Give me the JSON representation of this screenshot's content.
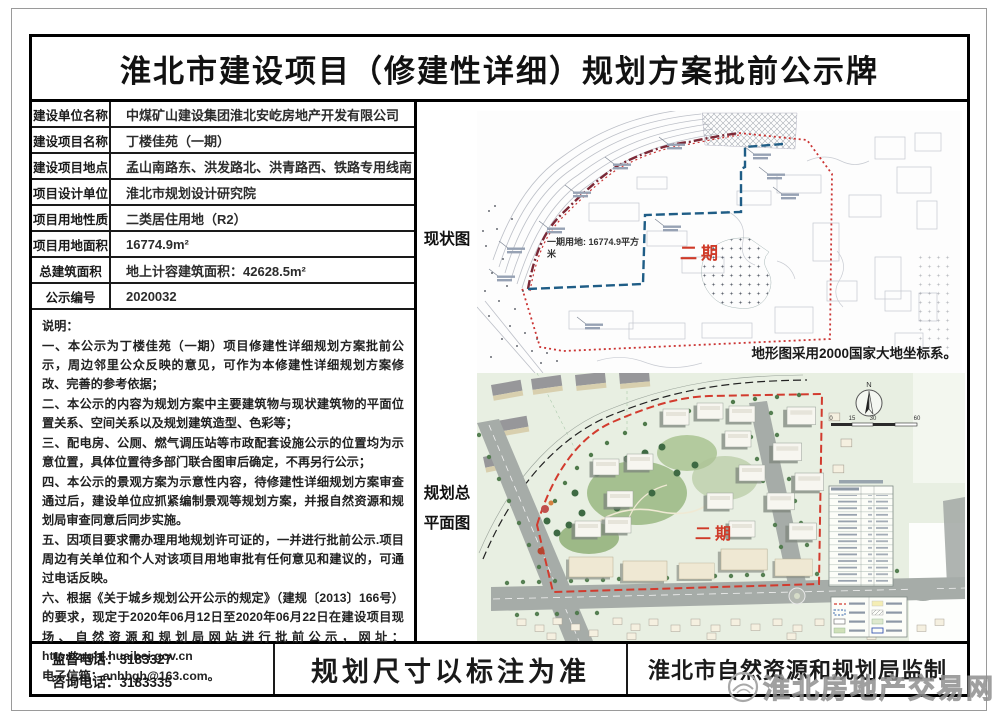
{
  "title": "淮北市建设项目（修建性详细）规划方案批前公示牌",
  "info_table": {
    "rows": [
      {
        "label": "建设单位名称",
        "value": "中煤矿山建设集团淮北安屹房地产开发有限公司"
      },
      {
        "label": "建设项目名称",
        "value": "丁楼佳苑（一期）"
      },
      {
        "label": "建设项目地点",
        "value": "孟山南路东、洪发路北、洪青路西、铁路专用线南"
      },
      {
        "label": "项目设计单位",
        "value": "淮北市规划设计研究院"
      },
      {
        "label": "项目用地性质",
        "value": "二类居住用地（R2）"
      },
      {
        "label": "项目用地面积",
        "value": "16774.9m²"
      },
      {
        "label": "总建筑面积",
        "value": "地上计容建筑面积：42628.5m²"
      },
      {
        "label": "公示编号",
        "value": "2020032"
      }
    ]
  },
  "notes": {
    "heading": "说明：",
    "items": [
      "一、本公示为丁楼佳苑（一期）项目修建性详细规划方案批前公示，周边邻里公众反映的意见，可作为本修建性详细规划方案修改、完善的参考依据；",
      "二、本公示的内容为规划方案中主要建筑物与现状建筑物的平面位置关系、空间关系以及规划建筑造型、色彩等；",
      "三、配电房、公厕、燃气调压站等市政配套设施公示的位置均为示意位置，具体位置待多部门联合图审后确定，不再另行公示；",
      "四、本公示的景观方案为示意性内容，待修建性详细规划方案审查通过后，建设单位应抓紧编制景观等规划方案，并报自然资源和规划局审查同意后同步实施。",
      "五、因项目要求需办理用地规划许可证的，一并进行批前公示.项目周边有关单位和个人对该项目用地审批有任何意见和建议的，可通过电话反映。",
      "六、根据《关于城乡规划公开公示的规定》（建规〔2013〕166号）的要求，现定于2020年06月12日至2020年06月22日在建设项目现场、自然资源和规划局网站进行批前公示，网址：http://zrghj.huaibei.gov.cn"
    ],
    "email_line": "电子信箱：anhbgh@163.com。"
  },
  "maps": {
    "site_map": {
      "side_label": "现状图",
      "phase1_area_text": "一期用地: 16774.9平方米",
      "phase2_label": "二期",
      "datum_note": "地形图采用2000国家大地坐标系。"
    },
    "plan_map": {
      "side_label_line1": "规划总",
      "side_label_line2": "平面图",
      "phase2_label": "二期",
      "compass_label": "N",
      "scale_ticks": [
        "0",
        "15",
        "30",
        "60"
      ]
    }
  },
  "footer": {
    "supervision_phone": "监督电话：3183327",
    "consult_phone": "咨询电话：3183335",
    "dimension_note": "规划尺寸以标注为准",
    "issuer": "淮北市自然资源和规划局监制"
  },
  "watermark": {
    "text": "淮北房地产交易网"
  },
  "colors": {
    "phase1_boundary": "#1f5d86",
    "phase1_arc": "#7b2836",
    "phase2_boundary": "#cb3433",
    "phase2_text": "#cf3a28",
    "plan_site_boundary": "#d23b2e",
    "board_border": "#000000"
  }
}
